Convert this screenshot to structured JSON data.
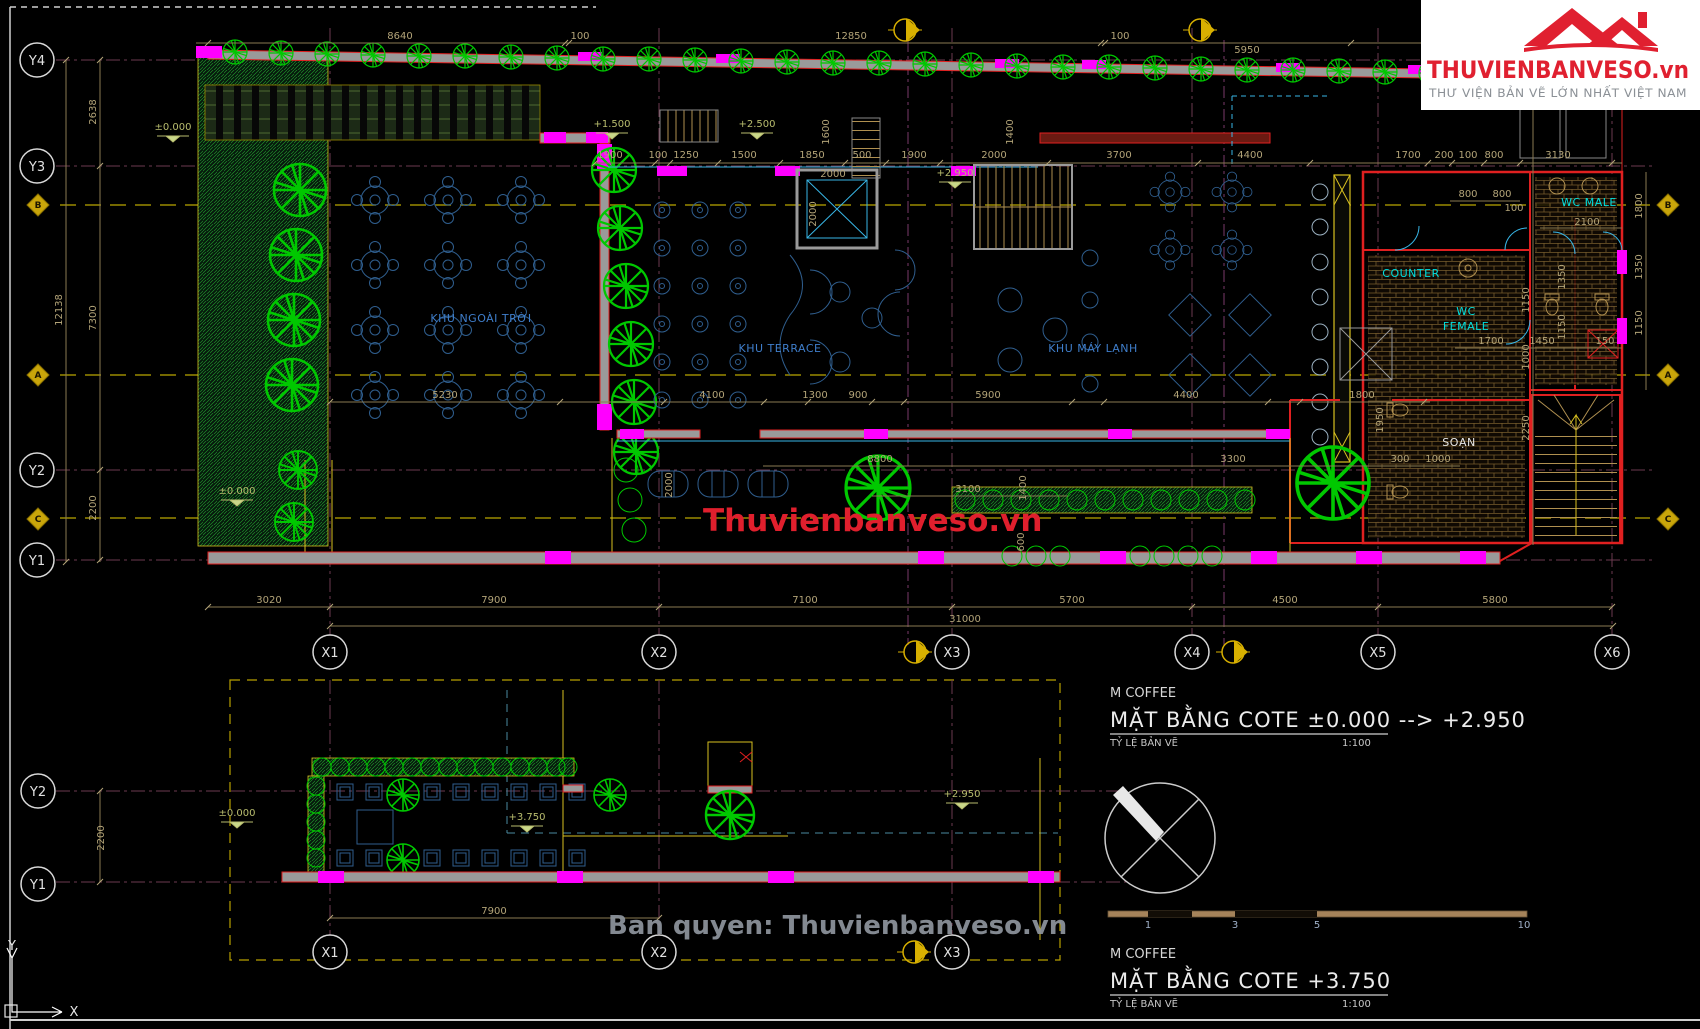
{
  "logo": {
    "brand": "THUVIENBANVESO.vn",
    "tagline": "THƯ VIỆN BẢN VẼ LỚN NHẤT VIỆT NAM"
  },
  "watermarks": {
    "center": "Thuvienbanveso.vn",
    "bottom": "Ban quyen: Thuvienbanveso.vn"
  },
  "titles": {
    "block1": {
      "project": "M COFFEE",
      "title": "MẶT BẰNG COTE ±0.000 --> +2.950",
      "scale_label": "TỶ LỆ BẢN VẼ",
      "scale": "1:100"
    },
    "block2": {
      "project": "M COFFEE",
      "title": "MẶT BẰNG COTE +3.750",
      "scale_label": "TỶ LỆ BẢN VẼ",
      "scale": "1:100"
    }
  },
  "scalebar": {
    "labels": [
      "1",
      "3",
      "5",
      "10"
    ]
  },
  "axes": {
    "y_main": [
      "Y4",
      "Y3",
      "Y2",
      "Y1"
    ],
    "x_main": [
      "X1",
      "X2",
      "X3",
      "X4",
      "X5",
      "X6"
    ],
    "letters": [
      "B",
      "A",
      "C"
    ],
    "y_plan2": [
      "Y2",
      "Y1"
    ],
    "x_plan2": [
      "X1",
      "X2",
      "X3"
    ],
    "ucs": {
      "x": "X",
      "y": "Y"
    }
  },
  "rooms": {
    "outdoor": "KHU NGOÀI TRỜI",
    "terrace": "KHU TERRACE",
    "ac": "KHU MÁY LẠNH",
    "counter": "COUNTER",
    "wc_male": "WC MALE",
    "wc_female_1": "WC",
    "wc_female_2": "FEMALE",
    "prep": "SOẠN"
  },
  "levels": {
    "zero_top": "±0.000",
    "p15": "+1.500",
    "p25": "+2.500",
    "p295_top": "+2.950",
    "zero_left": "±0.000",
    "p2_zero": "±0.000",
    "p2_375": "+3.750",
    "p2_295": "+2.950"
  },
  "dims": {
    "top": [
      "8640",
      "100",
      "12850",
      "100",
      "5950"
    ],
    "row2": [
      "1900",
      "100",
      "1250",
      "1500",
      "1850",
      "500",
      "1900",
      "2000",
      "3700",
      "4400",
      "1700",
      "200",
      "100",
      "800",
      "3130"
    ],
    "row2v": [
      "1600",
      "1400"
    ],
    "elev": [
      "2000",
      "2000"
    ],
    "mid": [
      "5230",
      "4100",
      "1300",
      "900",
      "5900",
      "4400",
      "1800"
    ],
    "lower": [
      "8800",
      "3100",
      "3300",
      "300",
      "1000"
    ],
    "lowerv": [
      "2000",
      "1400",
      "600",
      "1950"
    ],
    "bottom": [
      "3020",
      "7900",
      "7100",
      "5700",
      "4500",
      "5800"
    ],
    "total": "31000",
    "left": [
      "2638",
      "7300",
      "2200"
    ],
    "left_total": "12138",
    "right_inner": [
      "1800",
      "1350",
      "1150"
    ],
    "right_outer": [
      "1150",
      "1000",
      "2250"
    ],
    "wc": [
      "800",
      "800",
      "100",
      "2100",
      "1700",
      "1450",
      "150"
    ],
    "wc_v": [
      "1350",
      "1150"
    ],
    "p2_left": "2200",
    "p2_bottom": "7900"
  }
}
